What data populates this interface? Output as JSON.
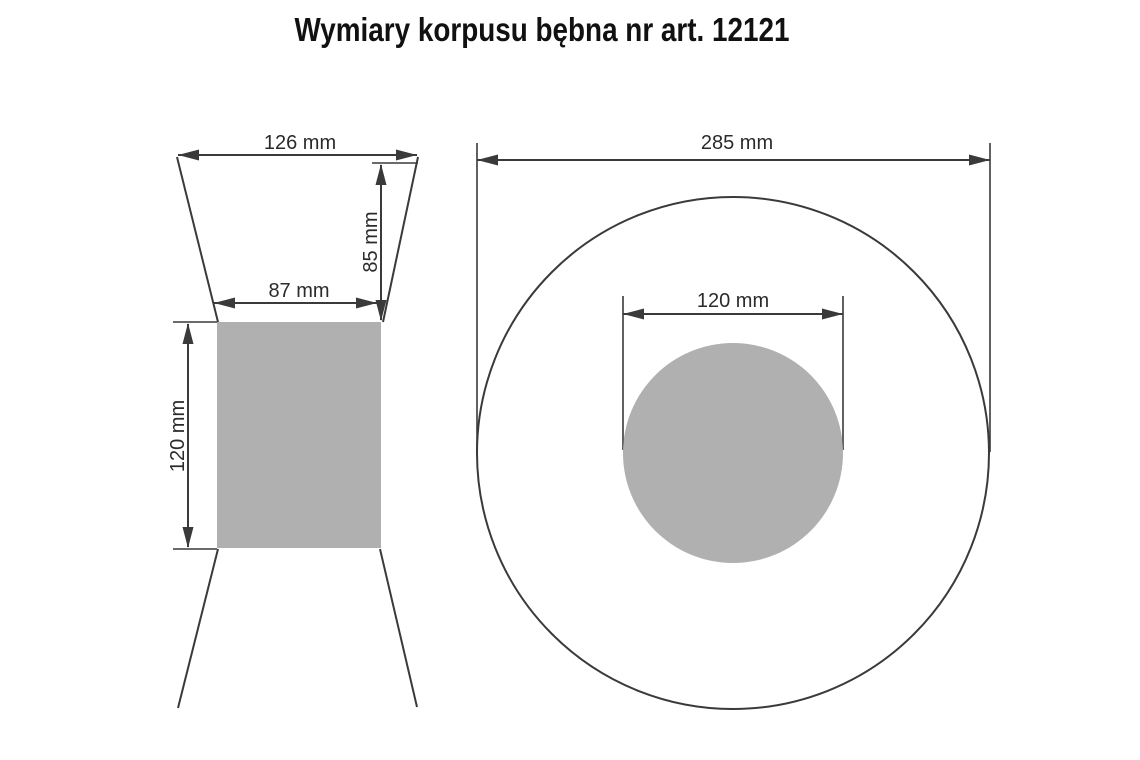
{
  "title": "Wymiary korpusu bębna nr art. 12121",
  "views": {
    "side": {
      "label_flange_outer_width": "126 mm",
      "label_flange_height": "85 mm",
      "label_core_width": "87 mm",
      "label_core_height": "120 mm"
    },
    "front": {
      "label_outer_diameter": "285 mm",
      "label_core_diameter": "120 mm"
    }
  },
  "colors": {
    "fill_gray": "#b0b0b0",
    "line": "#3a3a3a"
  }
}
